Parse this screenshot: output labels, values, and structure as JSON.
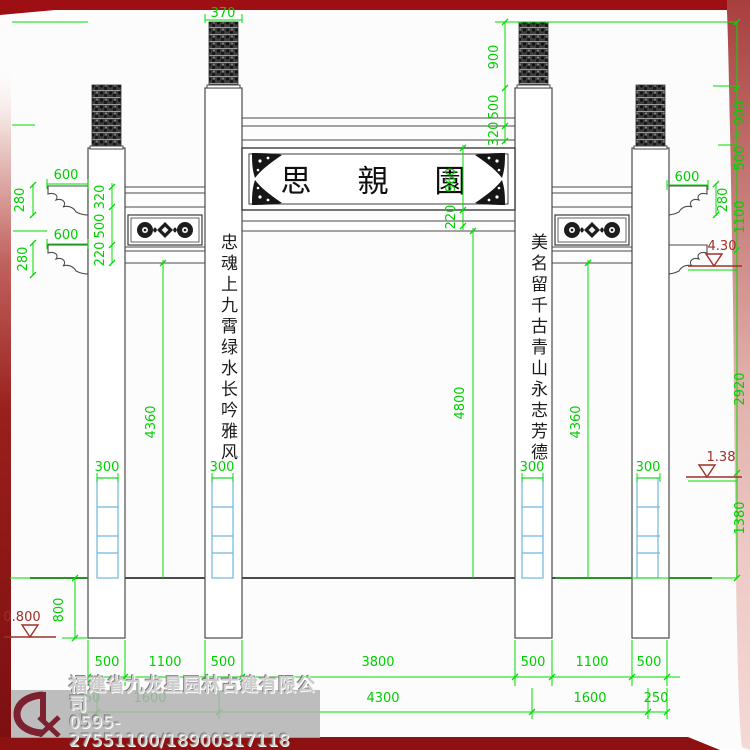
{
  "drawing": {
    "plaque_text": "思親園",
    "left_couplet": "忠魂上九霄绿水长吟雅风",
    "right_couplet": "美名留千古青山永志芳德",
    "dimensions": [
      {
        "t": "370",
        "x": 223,
        "y": 17,
        "r": 0
      },
      {
        "t": "900",
        "x": 498,
        "y": 57,
        "r": -90
      },
      {
        "t": "500",
        "x": 498,
        "y": 107,
        "r": -90
      },
      {
        "t": "320",
        "x": 498,
        "y": 134,
        "r": -90
      },
      {
        "t": "600",
        "x": 66,
        "y": 179,
        "r": 0
      },
      {
        "t": "280",
        "x": 24,
        "y": 200,
        "r": -90
      },
      {
        "t": "600",
        "x": 66,
        "y": 239,
        "r": 0
      },
      {
        "t": "280",
        "x": 27,
        "y": 259,
        "r": -90
      },
      {
        "t": "320",
        "x": 104,
        "y": 197,
        "r": -90
      },
      {
        "t": "500",
        "x": 104,
        "y": 226,
        "r": -90
      },
      {
        "t": "220",
        "x": 104,
        "y": 254,
        "r": -90
      },
      {
        "t": "960",
        "x": 455,
        "y": 180,
        "r": -90
      },
      {
        "t": "220",
        "x": 455,
        "y": 217,
        "r": -90
      },
      {
        "t": "600",
        "x": 687,
        "y": 181,
        "r": 0
      },
      {
        "t": "280",
        "x": 727,
        "y": 200,
        "r": -90
      },
      {
        "t": "900",
        "x": 744,
        "y": 113,
        "r": -90
      },
      {
        "t": "500",
        "x": 744,
        "y": 158,
        "r": -90
      },
      {
        "t": "1100",
        "x": 744,
        "y": 217,
        "r": -90
      },
      {
        "t": "2920",
        "x": 744,
        "y": 389,
        "r": -90
      },
      {
        "t": "1380",
        "x": 744,
        "y": 518,
        "r": -90
      },
      {
        "t": "4800",
        "x": 464,
        "y": 403,
        "r": -90
      },
      {
        "t": "4360",
        "x": 155,
        "y": 422,
        "r": -90
      },
      {
        "t": "4360",
        "x": 580,
        "y": 422,
        "r": -90
      },
      {
        "t": "300",
        "x": 107,
        "y": 471,
        "r": 0
      },
      {
        "t": "300",
        "x": 222,
        "y": 471,
        "r": 0
      },
      {
        "t": "300",
        "x": 532,
        "y": 471,
        "r": 0
      },
      {
        "t": "300",
        "x": 648,
        "y": 471,
        "r": 0
      },
      {
        "t": "800",
        "x": 63,
        "y": 610,
        "r": -90
      },
      {
        "t": "500",
        "x": 107,
        "y": 666,
        "r": 0
      },
      {
        "t": "1100",
        "x": 165,
        "y": 666,
        "r": 0
      },
      {
        "t": "500",
        "x": 223,
        "y": 666,
        "r": 0
      },
      {
        "t": "3800",
        "x": 378,
        "y": 666,
        "r": 0
      },
      {
        "t": "500",
        "x": 533,
        "y": 666,
        "r": 0
      },
      {
        "t": "1100",
        "x": 592,
        "y": 666,
        "r": 0
      },
      {
        "t": "500",
        "x": 649,
        "y": 666,
        "r": 0
      },
      {
        "t": "250",
        "x": 88,
        "y": 702,
        "r": 0
      },
      {
        "t": "1600",
        "x": 150,
        "y": 702,
        "r": 0
      },
      {
        "t": "4300",
        "x": 383,
        "y": 702,
        "r": 0
      },
      {
        "t": "1600",
        "x": 590,
        "y": 702,
        "r": 0
      },
      {
        "t": "250",
        "x": 656,
        "y": 702,
        "r": 0
      }
    ],
    "elevations": [
      {
        "label": "4.30"
      },
      {
        "label": "1.38"
      },
      {
        "label": "0.800"
      }
    ]
  },
  "watermark": {
    "company": "福建省九龙星园林古建有限公司",
    "phone": "0595-27551100/18900317118"
  },
  "colors": {
    "dimension_green": "#00cf00",
    "line_gray": "#4a4a4a",
    "footing_blue": "#6fb7dd",
    "border_red": "#9e0f14",
    "elevation_red": "#a03028",
    "watermark_gray": "#b0b0b0"
  }
}
